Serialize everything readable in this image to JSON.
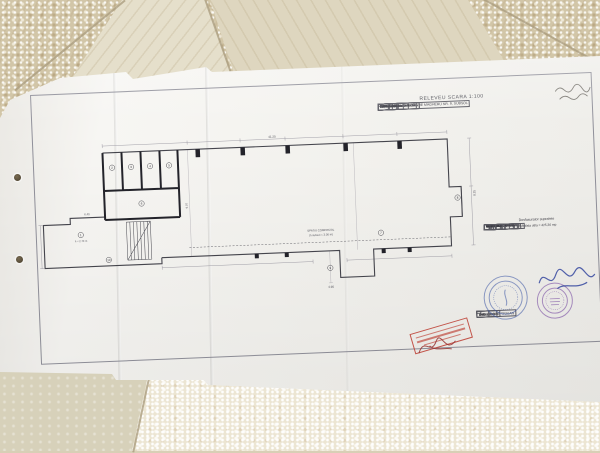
{
  "document": {
    "title": "RELEVEU SCARA 1:100",
    "cadastral_table": {
      "h_nr": "Nr. cadastral al terenului",
      "h_supraf": "Suprafata",
      "h_adresa": "Adresa imobilului",
      "nr_value": "19/-1.1",
      "supraf_value": "425,36 mp",
      "adresa_value": "B-DUL G-RAL GHEORGHE MAGHERU NR. 9, SUBSOL",
      "carte_label": "Carte Funciara colectiva",
      "carte_value": "1216",
      "uat_label": "UAT",
      "uat_value": "Sectorul 1",
      "cod_label": "Cod unitate individuala",
      "cf_label": "CF individuala"
    },
    "legend": {
      "title": "Desfasurator suprafete",
      "columns": [
        "Nr.",
        "Denumire incapere",
        "Suprafata utila (mp)"
      ],
      "rows": [
        [
          "1",
          "SPATIU ACCES",
          "20,40"
        ],
        [
          "2",
          "VESTIAR",
          "5,67"
        ],
        [
          "3",
          "HOL ACCES",
          "12,60"
        ],
        [
          "4",
          "GRUP SANITAR BARBATI",
          "3,97"
        ],
        [
          "5",
          "GRUP SANITAR FEMEI",
          "7,41"
        ],
        [
          "6",
          "MAGAZIE",
          "3,61"
        ],
        [
          "7",
          "SPATIU COMERCIAL",
          "335,09"
        ],
        [
          "8",
          "CENTRALA TERMICA",
          "1,98"
        ],
        [
          "9",
          "CASA LIFT",
          "6,36"
        ],
        [
          "10",
          "WINDFANG",
          "19,08"
        ]
      ],
      "total": "Suprafata utila = 425,36 mp"
    },
    "title_block": {
      "executant_label": "Executant",
      "data_label": "Data",
      "executant_name": "ING. DOBRE TRAIAN",
      "receptionat_label": "Receptionat",
      "data2_label": "Data"
    },
    "plan": {
      "room_numbers": [
        "1",
        "2",
        "3",
        "4",
        "5",
        "6",
        "7",
        "8",
        "9",
        "10"
      ],
      "center_label_1": "SPATIU COMERCIAL",
      "center_label_2": "(h subsol = 3.00 m)",
      "room1_note": "h = 2.70 m",
      "dims": [
        "41.20",
        "8.25",
        "4.90",
        "6.40",
        "9.07"
      ]
    }
  }
}
